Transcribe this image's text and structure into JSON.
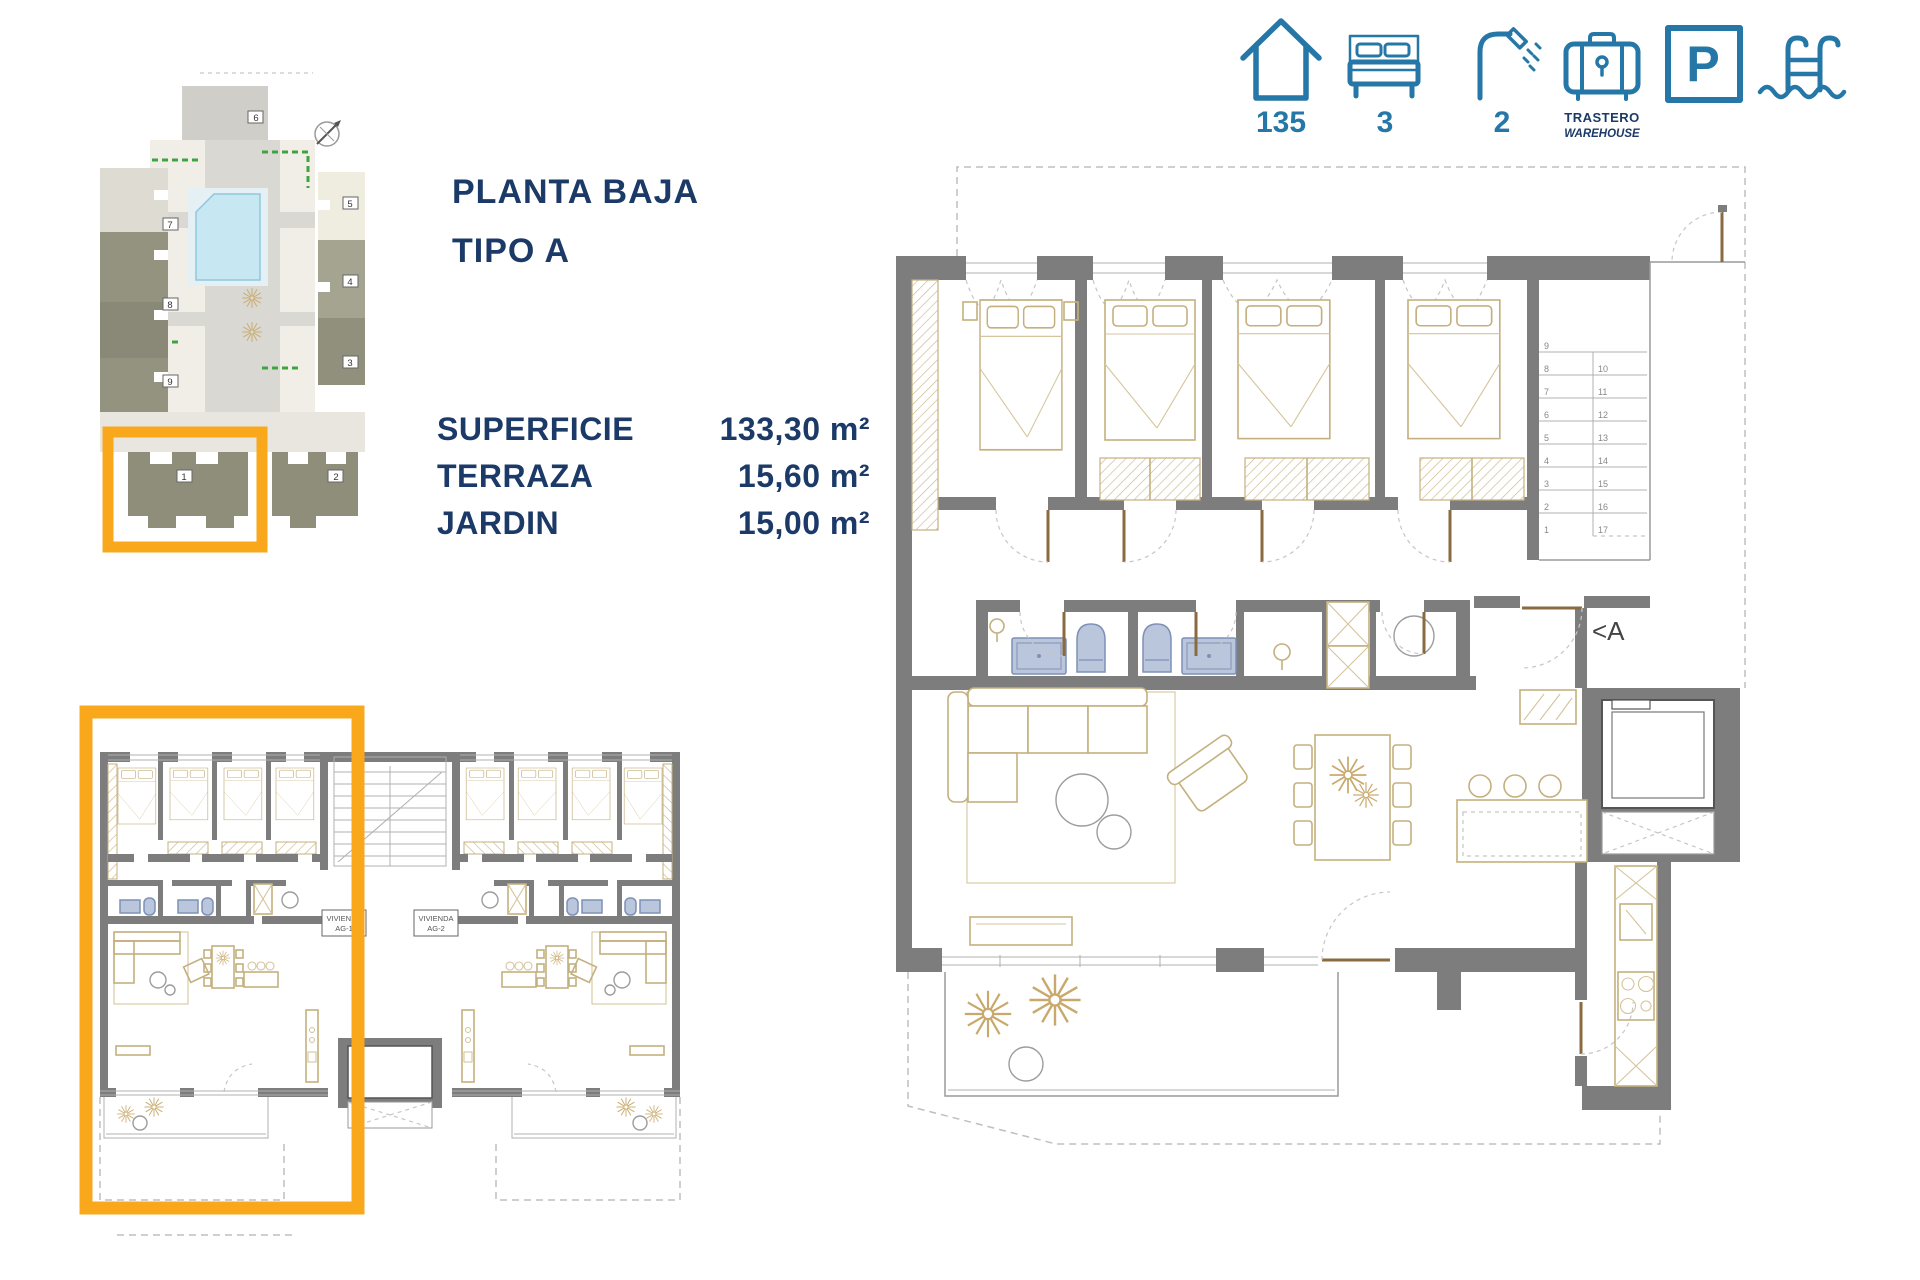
{
  "palette": {
    "icon_blue": "#2477A6",
    "navy_text": "#1C3A67",
    "highlight_orange": "#F9A81B",
    "wall_gray": "#7D7D7D",
    "furniture_tan": "#C4B07E",
    "fixture_blue": "#B9C6DC",
    "pool_blue": "#C7E8F2"
  },
  "title": {
    "line1": "PLANTA BAJA",
    "line2": "TIPO A"
  },
  "areas": [
    {
      "label": "SUPERFICIE",
      "value": "133,30 m²"
    },
    {
      "label": "TERRAZA",
      "value": "15,60 m²"
    },
    {
      "label": "JARDIN",
      "value": "15,00 m²"
    }
  ],
  "summary_icons": {
    "area": {
      "icon": "house-icon",
      "value": "135"
    },
    "bedrooms": {
      "icon": "bed-icon",
      "value": "3"
    },
    "bathrooms": {
      "icon": "shower-icon",
      "value": "2"
    },
    "storage": {
      "icon": "warehouse-icon",
      "label_primary": "TRASTERO",
      "label_secondary": "WAREHOUSE"
    },
    "parking": {
      "icon": "parking-icon",
      "letter": "P"
    },
    "pool": {
      "icon": "pool-icon"
    }
  },
  "site_plan": {
    "block_labels": [
      "1",
      "2",
      "3",
      "4",
      "5",
      "6",
      "7",
      "8",
      "9"
    ]
  },
  "ground_floor_plan": {
    "unit1": {
      "line1": "VIVIENDA",
      "line2": "AG-1"
    },
    "unit2": {
      "line1": "VIVIENDA",
      "line2": "AG-2"
    }
  },
  "main_plan": {
    "section_marker": "<A",
    "stair_steps_left": [
      "9",
      "8",
      "7",
      "6",
      "5",
      "4",
      "3",
      "2",
      "1"
    ],
    "stair_steps_right": [
      "10",
      "11",
      "12",
      "13",
      "14",
      "15",
      "16",
      "17"
    ]
  }
}
